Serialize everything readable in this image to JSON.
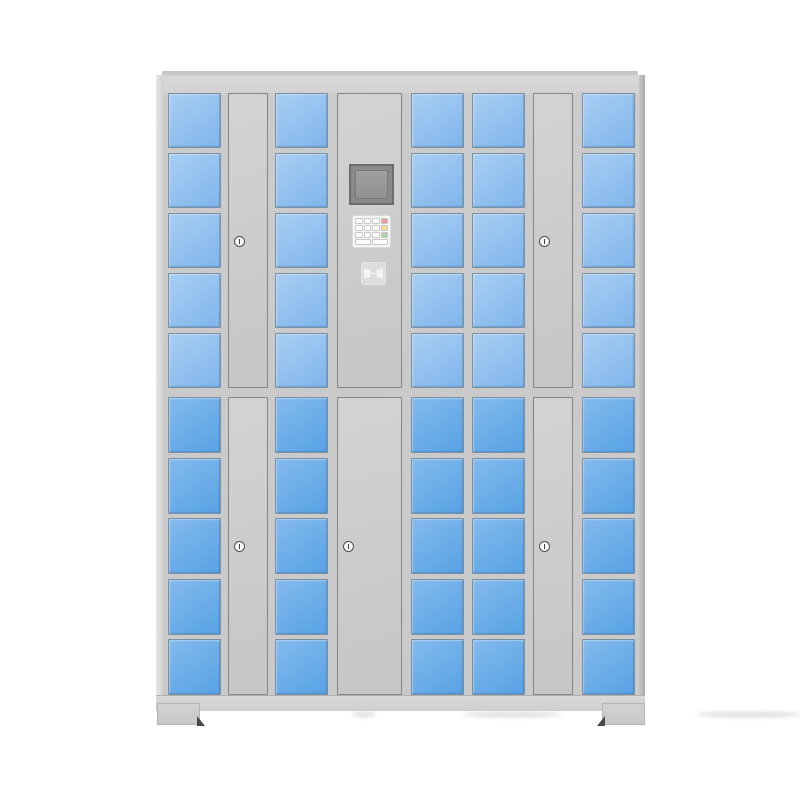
{
  "meta": {
    "description": "Product photo of a gray smart storage locker cabinet with blue glass doors, a central electronic control panel (screen, keypad, card reader) and five keyed service doors",
    "background": "#ffffff"
  },
  "palette": {
    "cabinet_frame": "#cbcbcb",
    "cabinet_top_rail": "#d8d8d8",
    "panel_fill": "#cdcdcd",
    "panel_border": "#858585",
    "door_border": "#7b8fa2",
    "upper_door_blue_top": "#a9cef3",
    "upper_door_blue_bottom": "#7fb5ec",
    "lower_door_blue_top": "#84baed",
    "lower_door_blue_bottom": "#57a2e5",
    "screen_bezel": "#6d6d6d",
    "screen_face": "#989898",
    "keypad_background": "#f5f5f5",
    "key_white": "#fdfdfd",
    "key_red": "#eb9c97",
    "key_yellow": "#f0e08e",
    "key_green": "#a8d7a4",
    "lock_ring": "#4f4f4f"
  },
  "cabinet": {
    "total_small_doors": 50,
    "locks": 5,
    "feet": 2,
    "control_panel": {
      "has_screen": true,
      "has_card_reader": true,
      "keypad": {
        "rows": 4,
        "cols": 4,
        "side_key_colors": [
          "#eb9c97",
          "#f0e08e",
          "#a8d7a4"
        ]
      }
    },
    "banks": [
      {
        "name": "upper",
        "rows": 5,
        "door_top_color": "#a9cef3",
        "door_bottom_color": "#7fb5ec",
        "columns": [
          {
            "type": "doors",
            "count": 5
          },
          {
            "type": "lock-panel"
          },
          {
            "type": "doors",
            "count": 5
          },
          {
            "type": "control-panel"
          },
          {
            "type": "doors",
            "count": 5
          },
          {
            "type": "doors",
            "count": 5
          },
          {
            "type": "lock-panel"
          },
          {
            "type": "doors",
            "count": 5
          }
        ]
      },
      {
        "name": "lower",
        "rows": 5,
        "door_top_color": "#84baed",
        "door_bottom_color": "#57a2e5",
        "columns": [
          {
            "type": "doors",
            "count": 5
          },
          {
            "type": "lock-panel"
          },
          {
            "type": "doors",
            "count": 5
          },
          {
            "type": "large-door"
          },
          {
            "type": "doors",
            "count": 5
          },
          {
            "type": "doors",
            "count": 5
          },
          {
            "type": "lock-panel"
          },
          {
            "type": "doors",
            "count": 5
          }
        ]
      }
    ]
  }
}
